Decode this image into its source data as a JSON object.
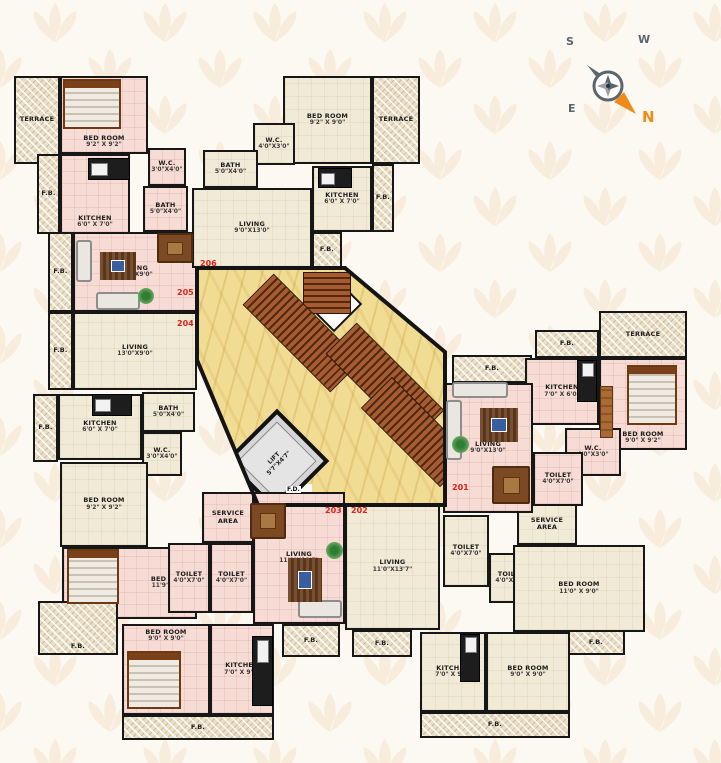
{
  "compass": {
    "s": "S",
    "w": "W",
    "e": "E",
    "n": "N",
    "north_color": "#ef8b17"
  },
  "lift": {
    "name": "LIFT",
    "dims": "5'7\"X4'7\""
  },
  "fd": "F.D.",
  "flat_numbers": [
    {
      "no": "206",
      "x": 200,
      "y": 259
    },
    {
      "no": "205",
      "x": 177,
      "y": 288
    },
    {
      "no": "204",
      "x": 177,
      "y": 319
    },
    {
      "no": "203",
      "x": 325,
      "y": 506
    },
    {
      "no": "202",
      "x": 351,
      "y": 506
    },
    {
      "no": "201",
      "x": 452,
      "y": 483
    }
  ],
  "rooms": [
    {
      "id": "terrace-205",
      "name": "TERRACE",
      "dims": "",
      "x": 14,
      "y": 76,
      "w": 46,
      "h": 88,
      "fill": "hatch"
    },
    {
      "id": "bedroom-205",
      "name": "BED ROOM",
      "dims": "9'2\" X 9'2\"",
      "x": 60,
      "y": 76,
      "w": 88,
      "h": 78,
      "fill": "pink",
      "align": "bottom"
    },
    {
      "id": "fb-205a",
      "name": "F.B.",
      "dims": "",
      "x": 37,
      "y": 154,
      "w": 23,
      "h": 80,
      "fill": "hatch"
    },
    {
      "id": "kitchen-205",
      "name": "KITCHEN",
      "dims": "6'0\" X 7'0\"",
      "x": 60,
      "y": 154,
      "w": 70,
      "h": 80,
      "fill": "pink",
      "align": "bottom"
    },
    {
      "id": "wc-205",
      "name": "W.C.",
      "dims": "3'0\"X4'0\"",
      "x": 148,
      "y": 148,
      "w": 38,
      "h": 38,
      "fill": "pink"
    },
    {
      "id": "bath-205",
      "name": "BATH",
      "dims": "5'0\"X4'0\"",
      "x": 143,
      "y": 186,
      "w": 45,
      "h": 46,
      "fill": "pink"
    },
    {
      "id": "fb-205b",
      "name": "F.B.",
      "dims": "",
      "x": 48,
      "y": 232,
      "w": 25,
      "h": 80,
      "fill": "hatch"
    },
    {
      "id": "living-205",
      "name": "LIVING",
      "dims": "13'0\"X9'0\"",
      "x": 73,
      "y": 232,
      "w": 124,
      "h": 80,
      "fill": "pink"
    },
    {
      "id": "bedroom-206",
      "name": "BED ROOM",
      "dims": "9'2\" X 9'0\"",
      "x": 283,
      "y": 76,
      "w": 89,
      "h": 88,
      "fill": "cream"
    },
    {
      "id": "terrace-206",
      "name": "TERRACE",
      "dims": "",
      "x": 372,
      "y": 76,
      "w": 48,
      "h": 88,
      "fill": "hatch"
    },
    {
      "id": "wc-206",
      "name": "W.C.",
      "dims": "4'0\"X3'0\"",
      "x": 253,
      "y": 123,
      "w": 42,
      "h": 42,
      "fill": "cream"
    },
    {
      "id": "bath-206",
      "name": "BATH",
      "dims": "5'0\"X4'0\"",
      "x": 203,
      "y": 150,
      "w": 55,
      "h": 38,
      "fill": "cream"
    },
    {
      "id": "living-206",
      "name": "LIVING",
      "dims": "9'0\"X13'0\"",
      "x": 192,
      "y": 188,
      "w": 120,
      "h": 80,
      "fill": "cream"
    },
    {
      "id": "kitchen-206",
      "name": "KITCHEN",
      "dims": "6'0\" X 7'0\"",
      "x": 312,
      "y": 166,
      "w": 60,
      "h": 66,
      "fill": "cream"
    },
    {
      "id": "fb-206a",
      "name": "F.B.",
      "dims": "",
      "x": 372,
      "y": 164,
      "w": 22,
      "h": 68,
      "fill": "hatch"
    },
    {
      "id": "fb-206b",
      "name": "F.B.",
      "dims": "",
      "x": 312,
      "y": 232,
      "w": 30,
      "h": 36,
      "fill": "hatch"
    },
    {
      "id": "living-204",
      "name": "LIVING",
      "dims": "13'0\"X9'0\"",
      "x": 73,
      "y": 312,
      "w": 124,
      "h": 78,
      "fill": "cream"
    },
    {
      "id": "fb-204a",
      "name": "F.B.",
      "dims": "",
      "x": 48,
      "y": 312,
      "w": 25,
      "h": 78,
      "fill": "hatch"
    },
    {
      "id": "fb-204b",
      "name": "F.B.",
      "dims": "",
      "x": 33,
      "y": 394,
      "w": 25,
      "h": 68,
      "fill": "hatch"
    },
    {
      "id": "kitchen-204",
      "name": "KITCHEN",
      "dims": "6'0\" X 7'0\"",
      "x": 58,
      "y": 394,
      "w": 84,
      "h": 66,
      "fill": "cream"
    },
    {
      "id": "bath-204",
      "name": "BATH",
      "dims": "5'0\"X4'0\"",
      "x": 142,
      "y": 392,
      "w": 53,
      "h": 40,
      "fill": "cream"
    },
    {
      "id": "wc-204",
      "name": "W.C.",
      "dims": "3'0\"X4'0\"",
      "x": 142,
      "y": 432,
      "w": 40,
      "h": 44,
      "fill": "cream"
    },
    {
      "id": "bedroom-204",
      "name": "BED ROOM",
      "dims": "9'2\" X 9'2\"",
      "x": 60,
      "y": 462,
      "w": 88,
      "h": 85,
      "fill": "cream"
    },
    {
      "id": "bedroom-203a",
      "name": "BED ROOM",
      "dims": "11'9\" X 9'0\"",
      "x": 62,
      "y": 547,
      "w": 135,
      "h": 72,
      "fill": "pink",
      "align": "right"
    },
    {
      "id": "fb-203a",
      "name": "F.B.",
      "dims": "",
      "x": 38,
      "y": 601,
      "w": 80,
      "h": 54,
      "fill": "hatch",
      "align": "bottom"
    },
    {
      "id": "bedroom-203b",
      "name": "BED ROOM",
      "dims": "9'0\" X 9'0\"",
      "x": 122,
      "y": 624,
      "w": 88,
      "h": 91,
      "fill": "pink",
      "align": "top"
    },
    {
      "id": "kitchen-203",
      "name": "KITCHEN",
      "dims": "7'0\" X 9'0\"",
      "x": 210,
      "y": 624,
      "w": 64,
      "h": 91,
      "fill": "pink"
    },
    {
      "id": "fb-203b",
      "name": "F.B.",
      "dims": "",
      "x": 122,
      "y": 715,
      "w": 152,
      "h": 25,
      "fill": "hatch"
    },
    {
      "id": "toilet-203a",
      "name": "TOILET",
      "dims": "4'0\"X7'0\"",
      "x": 168,
      "y": 543,
      "w": 42,
      "h": 70,
      "fill": "pink"
    },
    {
      "id": "toilet-203b",
      "name": "TOILET",
      "dims": "4'0\"X7'0\"",
      "x": 210,
      "y": 543,
      "w": 43,
      "h": 70,
      "fill": "pink"
    },
    {
      "id": "service-203",
      "name": "SERVICE AREA",
      "dims": "",
      "x": 202,
      "y": 492,
      "w": 52,
      "h": 51,
      "fill": "pink"
    },
    {
      "id": "living-203",
      "name": "LIVING",
      "dims": "11'0\"X13'7\"",
      "x": 253,
      "y": 492,
      "w": 92,
      "h": 132,
      "fill": "pink"
    },
    {
      "id": "fb-203c",
      "name": "F.B.",
      "dims": "",
      "x": 282,
      "y": 624,
      "w": 58,
      "h": 33,
      "fill": "hatch"
    },
    {
      "id": "living-202",
      "name": "LIVING",
      "dims": "11'0\"X13'7\"",
      "x": 345,
      "y": 503,
      "w": 95,
      "h": 127,
      "fill": "cream"
    },
    {
      "id": "fb-202a",
      "name": "F.B.",
      "dims": "",
      "x": 352,
      "y": 630,
      "w": 60,
      "h": 27,
      "fill": "hatch"
    },
    {
      "id": "toilet-202a",
      "name": "TOILET",
      "dims": "4'0\"X7'0\"",
      "x": 443,
      "y": 515,
      "w": 46,
      "h": 72,
      "fill": "cream"
    },
    {
      "id": "toilet-202b",
      "name": "TOILET",
      "dims": "4'0\"X7'0\"",
      "x": 489,
      "y": 553,
      "w": 44,
      "h": 50,
      "fill": "cream"
    },
    {
      "id": "service-202",
      "name": "SERVICE AREA",
      "dims": "",
      "x": 517,
      "y": 503,
      "w": 60,
      "h": 42,
      "fill": "cream"
    },
    {
      "id": "bedroom-202a",
      "name": "BED ROOM",
      "dims": "11'0\" X 9'0\"",
      "x": 513,
      "y": 545,
      "w": 132,
      "h": 87,
      "fill": "cream"
    },
    {
      "id": "fb-202b",
      "name": "F.B.",
      "dims": "",
      "x": 567,
      "y": 630,
      "w": 58,
      "h": 25,
      "fill": "hatch"
    },
    {
      "id": "kitchen-202",
      "name": "KITCHEN",
      "dims": "7'0\" X 9'0\"",
      "x": 420,
      "y": 632,
      "w": 66,
      "h": 80,
      "fill": "cream"
    },
    {
      "id": "bedroom-202b",
      "name": "BED ROOM",
      "dims": "9'0\" X 9'0\"",
      "x": 486,
      "y": 632,
      "w": 84,
      "h": 80,
      "fill": "cream"
    },
    {
      "id": "fb-202c",
      "name": "F.B.",
      "dims": "",
      "x": 420,
      "y": 712,
      "w": 150,
      "h": 26,
      "fill": "hatch"
    },
    {
      "id": "fb-201a",
      "name": "F.B.",
      "dims": "",
      "x": 452,
      "y": 355,
      "w": 80,
      "h": 28,
      "fill": "hatch"
    },
    {
      "id": "fb-201b",
      "name": "F.B.",
      "dims": "",
      "x": 535,
      "y": 330,
      "w": 64,
      "h": 28,
      "fill": "hatch"
    },
    {
      "id": "terrace-201",
      "name": "TERRACE",
      "dims": "",
      "x": 599,
      "y": 311,
      "w": 88,
      "h": 47,
      "fill": "hatch"
    },
    {
      "id": "kitchen-201",
      "name": "KITCHEN",
      "dims": "7'0\" X 6'0\"",
      "x": 525,
      "y": 358,
      "w": 74,
      "h": 67,
      "fill": "pink"
    },
    {
      "id": "bedroom-201",
      "name": "BED ROOM",
      "dims": "9'0\" X 9'2\"",
      "x": 599,
      "y": 358,
      "w": 88,
      "h": 92,
      "fill": "pink",
      "align": "bottom"
    },
    {
      "id": "living-201",
      "name": "LIVING",
      "dims": "9'0\"X13'0\"",
      "x": 443,
      "y": 383,
      "w": 90,
      "h": 130,
      "fill": "pink"
    },
    {
      "id": "wc-201",
      "name": "W.C.",
      "dims": "4'0\"X3'0\"",
      "x": 565,
      "y": 428,
      "w": 56,
      "h": 48,
      "fill": "pink"
    },
    {
      "id": "toilet-201",
      "name": "TOILET",
      "dims": "4'0\"X7'0\"",
      "x": 533,
      "y": 452,
      "w": 50,
      "h": 54,
      "fill": "pink"
    }
  ]
}
